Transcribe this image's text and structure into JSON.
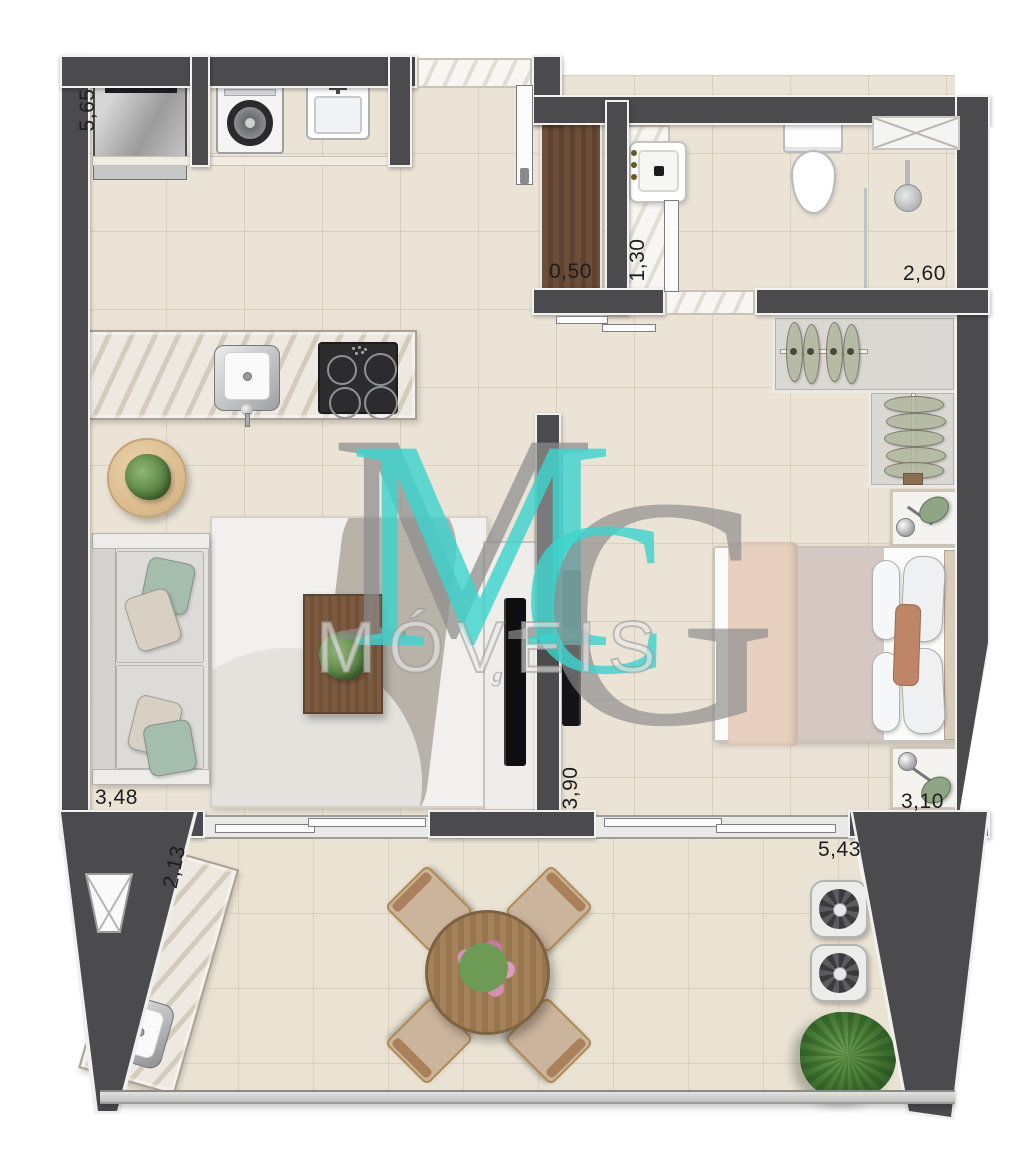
{
  "page": {
    "type": "apartment-floor-plan",
    "width": 1024,
    "height": 1164
  },
  "watermark": {
    "letter_m": "M",
    "letter_m_accent": "M",
    "letter_g": "G",
    "letter_c": "C",
    "brand": "MÓVEIS",
    "small_text": "g"
  },
  "dimensions": {
    "kitchen_top": "5,65",
    "entry_cabinet": "0,50",
    "bathroom": "1,30",
    "shower": "2,60",
    "living": "3,48",
    "hall": "3,90",
    "bedroom": "3,10",
    "balcony": "5,43",
    "balcony_side": "2,13"
  },
  "colors": {
    "wall": "#4b4b4d",
    "accent_cyan": "#3ed3cd",
    "floor": "#ebe4d6",
    "wood": "#6d4f39"
  }
}
